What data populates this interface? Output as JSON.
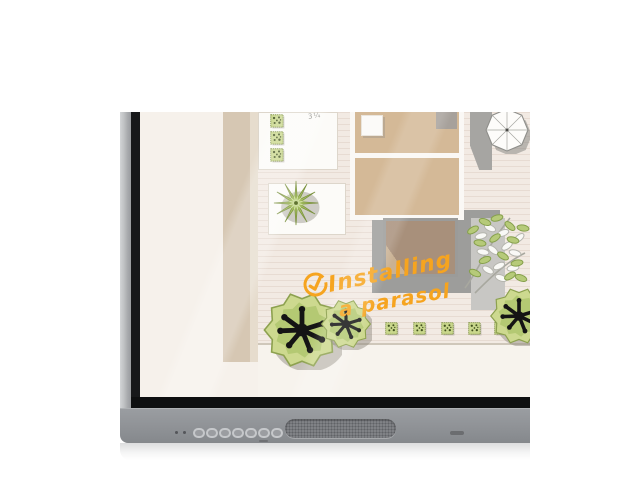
{
  "screen_annotation": {
    "icon": "check-circle-icon",
    "text_line1": "Installing",
    "text_line2": "a parasol",
    "ink_color": "#F6A41F"
  },
  "garden_plan": {
    "dimension_note": "3¼",
    "elements": {
      "house": "house-floor-plan-top-view",
      "parasol": "parasol-top-view",
      "trees": "tree-canopy-top-view",
      "hedges": "square-hedge-shrubs",
      "flower": "starburst-plant",
      "foliage": "leafy-branches"
    },
    "palette": {
      "paper": "#F5F0EA",
      "wall_band": "#D6C7B3",
      "room_fill": "#D4B997",
      "deck_fill": "#A8907B",
      "patio_gray": "#9D9D9B",
      "plant_green": "#C9D78C"
    }
  },
  "device": {
    "label": "interactive-display",
    "frame_color": "#B4B6B9",
    "inner_bezel_color": "#17181A",
    "chin_color": "#8F9296",
    "controls": {
      "status_dot_count": 2,
      "front_button_count": 7,
      "has_speaker_grille": true,
      "has_ir_window": true
    }
  }
}
